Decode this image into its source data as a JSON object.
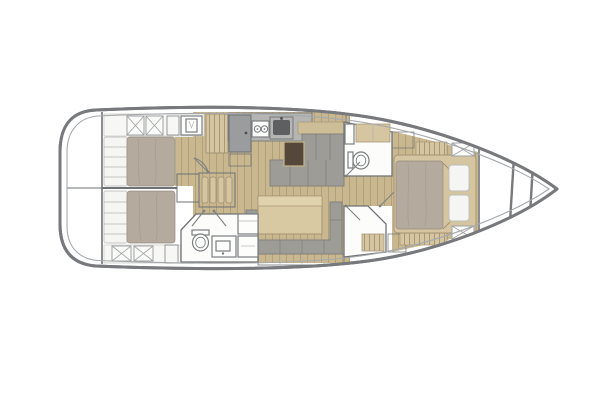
{
  "diagram": {
    "type": "floorplan",
    "subject": "sailing-yacht interior layout, plan view",
    "orientation": "bow-right",
    "canvas": {
      "width": 600,
      "height": 400
    }
  },
  "palette": {
    "background": "#ffffff",
    "hull_outline": "#77797c",
    "deck_line": "#a6a9ac",
    "wall": "#6f7274",
    "fixture": "#7b7e80",
    "wood": "#c9b78f",
    "wood_line": "#b2a078",
    "cabinet_tan": "#d5c5a0",
    "cabinet_tan_line": "#a89878",
    "wardrobe_tan": "#c9b68c",
    "bed_blanket": "#b4aa9e",
    "bed_pillow": "#f5f5f3",
    "settee_gray": "#9d9c97",
    "settee_back_tan": "#cebe98",
    "table_tan": "#d9c9a3",
    "table_top": "#e0d2ac",
    "dark_brown": "#55483b",
    "counter_gray": "#b5b6b4",
    "appliance_gray": "#9a9c9d",
    "sink_dark": "#5d5f61",
    "hatch_gray": "#cbcdce",
    "hatch_line": "#8f9294"
  },
  "areas": [
    {
      "id": "stern-garage"
    },
    {
      "id": "aft-cabin-port"
    },
    {
      "id": "aft-cabin-starboard"
    },
    {
      "id": "aft-head"
    },
    {
      "id": "companionway-stairs"
    },
    {
      "id": "galley"
    },
    {
      "id": "salon-settee"
    },
    {
      "id": "dinette"
    },
    {
      "id": "forward-head"
    },
    {
      "id": "shower-room"
    },
    {
      "id": "forward-cabin"
    },
    {
      "id": "bow-locker"
    }
  ],
  "furniture_icons": [
    "double-bed-icon",
    "pillow-icon",
    "stove-icon",
    "sink-icon",
    "fridge-icon",
    "toilet-icon",
    "vanity-sink-icon",
    "table-icon",
    "settee-icon",
    "stairs-icon",
    "wardrobe-icon",
    "locker-x-icon",
    "door-swing-icon",
    "bench-icon"
  ]
}
